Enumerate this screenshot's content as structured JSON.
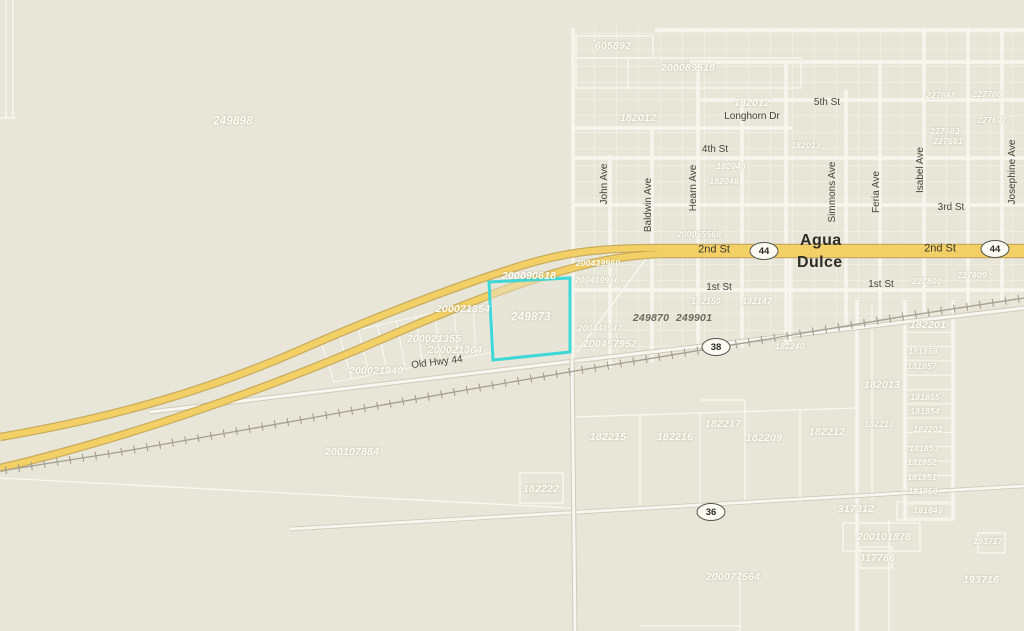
{
  "map": {
    "town": {
      "line1": "Agua",
      "line2": "Dulce"
    },
    "highlighted_parcel": {
      "id": "249873",
      "outline_color": "#3fd8d8"
    },
    "colors": {
      "background": "#e8e6d8",
      "street": "#f7f6ee",
      "parcel_line": "#fbfaf2",
      "highway_fill": "#f3d065",
      "highway_casing": "#c2a04a",
      "railroad": "#a29e92",
      "white_label": "#fffdf4",
      "dark_label": "#6e6a5e",
      "highlight": "#3fd8d8"
    },
    "shields": [
      {
        "route": "44",
        "x": 764,
        "y": 251
      },
      {
        "route": "44",
        "x": 995,
        "y": 249
      },
      {
        "route": "38",
        "x": 716,
        "y": 347
      },
      {
        "route": "36",
        "x": 711,
        "y": 512
      }
    ],
    "street_labels": [
      {
        "t": "2nd St",
        "x": 714,
        "y": 250,
        "c": "street lg",
        "r": 0
      },
      {
        "t": "2nd St",
        "x": 940,
        "y": 249,
        "c": "street lg",
        "r": 0
      },
      {
        "t": "1st St",
        "x": 719,
        "y": 288,
        "c": "street",
        "r": 0
      },
      {
        "t": "1st St",
        "x": 881,
        "y": 285,
        "c": "street",
        "r": 0
      },
      {
        "t": "3rd St",
        "x": 951,
        "y": 208,
        "c": "street",
        "r": 0
      },
      {
        "t": "4th St",
        "x": 715,
        "y": 150,
        "c": "street",
        "r": 0
      },
      {
        "t": "5th St",
        "x": 827,
        "y": 103,
        "c": "street",
        "r": 0
      },
      {
        "t": "Longhorn Dr",
        "x": 752,
        "y": 117,
        "c": "street",
        "r": 0
      },
      {
        "t": "Old Hwy 44",
        "x": 437,
        "y": 363,
        "c": "street",
        "r": -7
      },
      {
        "t": "John Ave",
        "x": 605,
        "y": 184,
        "c": "street",
        "r": -90
      },
      {
        "t": "Baldwin Ave",
        "x": 649,
        "y": 205,
        "c": "street",
        "r": -90
      },
      {
        "t": "Hearn Ave",
        "x": 694,
        "y": 188,
        "c": "street",
        "r": -90
      },
      {
        "t": "Simmons Ave",
        "x": 833,
        "y": 192,
        "c": "street",
        "r": -90
      },
      {
        "t": "Feria Ave",
        "x": 877,
        "y": 192,
        "c": "street",
        "r": -90
      },
      {
        "t": "Isabel Ave",
        "x": 921,
        "y": 170,
        "c": "street",
        "r": -90
      },
      {
        "t": "Josephine Ave",
        "x": 1013,
        "y": 172,
        "c": "street",
        "r": -90
      }
    ],
    "parcel_labels": [
      {
        "t": "249898",
        "x": 233,
        "y": 122,
        "c": "pl lg"
      },
      {
        "t": "605892",
        "x": 613,
        "y": 46,
        "c": "pl"
      },
      {
        "t": "200089518",
        "x": 688,
        "y": 68,
        "c": "pl"
      },
      {
        "t": "182012",
        "x": 638,
        "y": 118,
        "c": "pl"
      },
      {
        "t": "182012",
        "x": 752,
        "y": 103,
        "c": "pl"
      },
      {
        "t": "182046",
        "x": 731,
        "y": 166,
        "c": "pl sm"
      },
      {
        "t": "182048",
        "x": 724,
        "y": 181,
        "c": "pl sm"
      },
      {
        "t": "182013",
        "x": 806,
        "y": 145,
        "c": "pl sm"
      },
      {
        "t": "227688",
        "x": 941,
        "y": 95,
        "c": "pl sm"
      },
      {
        "t": "227706",
        "x": 987,
        "y": 94,
        "c": "pl sm"
      },
      {
        "t": "227697",
        "x": 992,
        "y": 120,
        "c": "pl sm"
      },
      {
        "t": "227682",
        "x": 945,
        "y": 131,
        "c": "pl sm"
      },
      {
        "t": "227681",
        "x": 948,
        "y": 141,
        "c": "pl sm"
      },
      {
        "t": "200055568",
        "x": 699,
        "y": 234,
        "c": "pl sm"
      },
      {
        "t": "200090618",
        "x": 529,
        "y": 276,
        "c": "pl"
      },
      {
        "t": "200021354",
        "x": 463,
        "y": 309,
        "c": "pl"
      },
      {
        "t": "200021355",
        "x": 434,
        "y": 339,
        "c": "pl"
      },
      {
        "t": "200021364",
        "x": 455,
        "y": 350,
        "c": "pl"
      },
      {
        "t": "200021340",
        "x": 376,
        "y": 371,
        "c": "pl"
      },
      {
        "t": "200439960",
        "x": 598,
        "y": 263,
        "c": "pl sm"
      },
      {
        "t": "200439966",
        "x": 597,
        "y": 280,
        "c": "pl sm"
      },
      {
        "t": "200448947",
        "x": 600,
        "y": 328,
        "c": "pl sm"
      },
      {
        "t": "200457952",
        "x": 610,
        "y": 344,
        "c": "pl"
      },
      {
        "t": "249873",
        "x": 531,
        "y": 318,
        "c": "pl lg"
      },
      {
        "t": "249870",
        "x": 651,
        "y": 318,
        "c": "pl dark"
      },
      {
        "t": "249901",
        "x": 694,
        "y": 318,
        "c": "pl dark"
      },
      {
        "t": "182150",
        "x": 706,
        "y": 301,
        "c": "pl sm"
      },
      {
        "t": "182147",
        "x": 757,
        "y": 301,
        "c": "pl sm"
      },
      {
        "t": "227809",
        "x": 972,
        "y": 275,
        "c": "pl sm"
      },
      {
        "t": "227800",
        "x": 927,
        "y": 281,
        "c": "pl sm"
      },
      {
        "t": "182240",
        "x": 790,
        "y": 346,
        "c": "pl sm"
      },
      {
        "t": "182201",
        "x": 928,
        "y": 325,
        "c": "pl"
      },
      {
        "t": "181858",
        "x": 923,
        "y": 351,
        "c": "pl sm"
      },
      {
        "t": "181857",
        "x": 922,
        "y": 366,
        "c": "pl sm"
      },
      {
        "t": "182013",
        "x": 882,
        "y": 385,
        "c": "pl"
      },
      {
        "t": "181855",
        "x": 925,
        "y": 397,
        "c": "pl sm"
      },
      {
        "t": "181854",
        "x": 925,
        "y": 411,
        "c": "pl sm"
      },
      {
        "t": "182210",
        "x": 879,
        "y": 424,
        "c": "pl sm"
      },
      {
        "t": "182202",
        "x": 928,
        "y": 429,
        "c": "pl sm"
      },
      {
        "t": "181853",
        "x": 924,
        "y": 448,
        "c": "pl sm"
      },
      {
        "t": "181852",
        "x": 922,
        "y": 462,
        "c": "pl sm"
      },
      {
        "t": "181851",
        "x": 922,
        "y": 477,
        "c": "pl sm"
      },
      {
        "t": "181850",
        "x": 923,
        "y": 491,
        "c": "pl sm"
      },
      {
        "t": "317312",
        "x": 856,
        "y": 509,
        "c": "pl"
      },
      {
        "t": "181849",
        "x": 928,
        "y": 510,
        "c": "pl sm"
      },
      {
        "t": "200101878",
        "x": 884,
        "y": 537,
        "c": "pl"
      },
      {
        "t": "317786",
        "x": 877,
        "y": 558,
        "c": "pl"
      },
      {
        "t": "193717",
        "x": 988,
        "y": 541,
        "c": "pl sm"
      },
      {
        "t": "193716",
        "x": 981,
        "y": 580,
        "c": "pl"
      },
      {
        "t": "182215",
        "x": 608,
        "y": 437,
        "c": "pl"
      },
      {
        "t": "182216",
        "x": 675,
        "y": 437,
        "c": "pl"
      },
      {
        "t": "182217",
        "x": 723,
        "y": 424,
        "c": "pl"
      },
      {
        "t": "182209",
        "x": 764,
        "y": 438,
        "c": "pl"
      },
      {
        "t": "182212",
        "x": 827,
        "y": 432,
        "c": "pl"
      },
      {
        "t": "182222",
        "x": 541,
        "y": 489,
        "c": "pl"
      },
      {
        "t": "200107884",
        "x": 352,
        "y": 452,
        "c": "pl"
      },
      {
        "t": "200077564",
        "x": 733,
        "y": 577,
        "c": "pl"
      }
    ],
    "gen": {
      "right_lots": {
        "x1": 906,
        "x2": 952,
        "y0": 318,
        "dy": 14.3,
        "n": 15
      },
      "strip": {
        "ax": 320,
        "ay": 338,
        "bx": 492,
        "by": 300,
        "cx": 334,
        "cy": 382,
        "dx": 494,
        "dy": 352,
        "n": 9
      },
      "railroad_tick": {
        "spacing": 13,
        "half_len": 4
      }
    }
  }
}
